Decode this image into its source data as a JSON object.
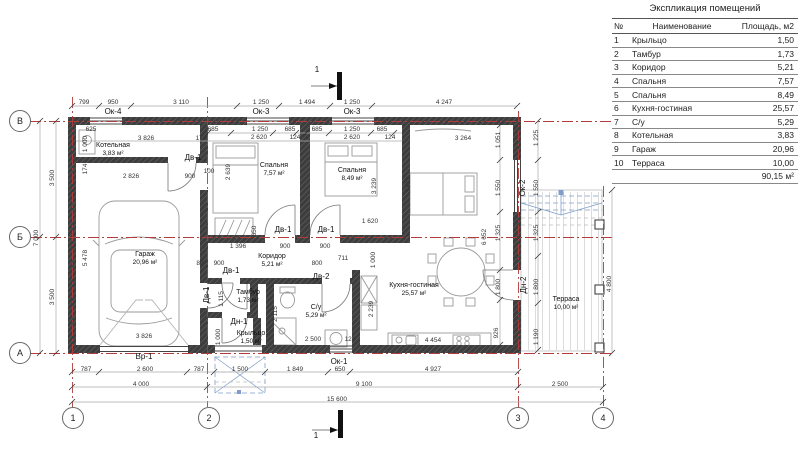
{
  "table": {
    "title": "Экспликация помещений",
    "headers": {
      "num": "№",
      "name": "Наименование",
      "area": "Площадь, м2"
    },
    "rows": [
      {
        "num": "1",
        "name": "Крыльцо",
        "area": "1,50"
      },
      {
        "num": "2",
        "name": "Тамбур",
        "area": "1,73"
      },
      {
        "num": "3",
        "name": "Коридор",
        "area": "5,21"
      },
      {
        "num": "4",
        "name": "Спальня",
        "area": "7,57"
      },
      {
        "num": "5",
        "name": "Спальня",
        "area": "8,49"
      },
      {
        "num": "6",
        "name": "Кухня-гостиная",
        "area": "25,57"
      },
      {
        "num": "7",
        "name": "С/у",
        "area": "5,29"
      },
      {
        "num": "8",
        "name": "Котельная",
        "area": "3,83"
      },
      {
        "num": "9",
        "name": "Гараж",
        "area": "20,96"
      },
      {
        "num": "10",
        "name": "Терраса",
        "area": "10,00"
      }
    ],
    "total": "90,15 м²"
  },
  "plan": {
    "rooms": [
      {
        "name": "Котельная",
        "area": "3,83 м²",
        "x": 113,
        "y": 150
      },
      {
        "name": "Гараж",
        "area": "20,96 м²",
        "x": 145,
        "y": 259
      },
      {
        "name": "Спальня",
        "area": "7,57 м²",
        "x": 274,
        "y": 170
      },
      {
        "name": "Спальня",
        "area": "8,49 м²",
        "x": 352,
        "y": 175
      },
      {
        "name": "Коридор",
        "area": "5,21 м²",
        "x": 272,
        "y": 261
      },
      {
        "name": "Тамбур",
        "area": "1,73 м²",
        "x": 248,
        "y": 297
      },
      {
        "name": "Крыльцо",
        "area": "1,50 м²",
        "x": 251,
        "y": 338
      },
      {
        "name": "С/у",
        "area": "5,29 м²",
        "x": 316,
        "y": 312
      },
      {
        "name": "Кухня-гостиная",
        "area": "25,57 м²",
        "x": 414,
        "y": 290
      },
      {
        "name": "Терраса",
        "area": "10,00 м²",
        "x": 566,
        "y": 304
      }
    ],
    "tags": [
      {
        "t": "Ок-4",
        "x": 113,
        "y": 112
      },
      {
        "t": "Ок-3",
        "x": 261,
        "y": 112
      },
      {
        "t": "Ок-3",
        "x": 352,
        "y": 112
      },
      {
        "t": "Ок-2",
        "x": 523,
        "y": 188,
        "v": 1
      },
      {
        "t": "Ок-1",
        "x": 339,
        "y": 362
      },
      {
        "t": "Вр-1",
        "x": 144,
        "y": 357
      },
      {
        "t": "Дв-1",
        "x": 193,
        "y": 158
      },
      {
        "t": "Дв-1",
        "x": 283,
        "y": 230
      },
      {
        "t": "Дв-1",
        "x": 326,
        "y": 230
      },
      {
        "t": "Дв-1",
        "x": 231,
        "y": 271
      },
      {
        "t": "Дв-1",
        "x": 207,
        "y": 295,
        "v": 1
      },
      {
        "t": "Дв-2",
        "x": 321,
        "y": 277
      },
      {
        "t": "Дн-1",
        "x": 239,
        "y": 322
      },
      {
        "t": "Дн-2",
        "x": 524,
        "y": 285,
        "v": 1
      }
    ],
    "sections": [
      {
        "t": "1",
        "x": 317,
        "y": 70
      },
      {
        "t": "1",
        "x": 316,
        "y": 436
      }
    ],
    "dims": [
      {
        "t": "799",
        "x": 84,
        "y": 103
      },
      {
        "t": "950",
        "x": 113,
        "y": 103
      },
      {
        "t": "3 110",
        "x": 181,
        "y": 103
      },
      {
        "t": "1 250",
        "x": 261,
        "y": 103
      },
      {
        "t": "1 494",
        "x": 307,
        "y": 103
      },
      {
        "t": "1 250",
        "x": 352,
        "y": 103
      },
      {
        "t": "4 247",
        "x": 444,
        "y": 103
      },
      {
        "t": "625",
        "x": 91,
        "y": 130
      },
      {
        "t": "685",
        "x": 213,
        "y": 130
      },
      {
        "t": "1 250",
        "x": 260,
        "y": 130
      },
      {
        "t": "685",
        "x": 290,
        "y": 130
      },
      {
        "t": "685",
        "x": 317,
        "y": 130
      },
      {
        "t": "1 250",
        "x": 352,
        "y": 130
      },
      {
        "t": "685",
        "x": 382,
        "y": 130
      },
      {
        "t": "3 826",
        "x": 146,
        "y": 139
      },
      {
        "t": "174",
        "x": 201,
        "y": 139
      },
      {
        "t": "2 620",
        "x": 259,
        "y": 138
      },
      {
        "t": "124",
        "x": 295,
        "y": 138
      },
      {
        "t": "2 620",
        "x": 352,
        "y": 138
      },
      {
        "t": "124",
        "x": 390,
        "y": 138
      },
      {
        "t": "3 264",
        "x": 463,
        "y": 139
      },
      {
        "t": "1 000",
        "x": 86,
        "y": 144,
        "v": 1
      },
      {
        "t": "174",
        "x": 86,
        "y": 169,
        "v": 1
      },
      {
        "t": "2 826",
        "x": 131,
        "y": 177
      },
      {
        "t": "900",
        "x": 190,
        "y": 177
      },
      {
        "t": "100",
        "x": 209,
        "y": 172
      },
      {
        "t": "2 639",
        "x": 229,
        "y": 172,
        "v": 1
      },
      {
        "t": "3 239",
        "x": 375,
        "y": 186,
        "v": 1
      },
      {
        "t": "3 413",
        "x": 409,
        "y": 185,
        "v": 1
      },
      {
        "t": "1 051",
        "x": 499,
        "y": 140,
        "v": 1
      },
      {
        "t": "1 225",
        "x": 537,
        "y": 138,
        "v": 1
      },
      {
        "t": "1 550",
        "x": 499,
        "y": 188,
        "v": 1
      },
      {
        "t": "1 550",
        "x": 537,
        "y": 188,
        "v": 1
      },
      {
        "t": "1 620",
        "x": 370,
        "y": 222
      },
      {
        "t": "650",
        "x": 255,
        "y": 231,
        "v": 1
      },
      {
        "t": "6 652",
        "x": 485,
        "y": 237,
        "v": 1
      },
      {
        "t": "1 325",
        "x": 499,
        "y": 233,
        "v": 1
      },
      {
        "t": "1 325",
        "x": 537,
        "y": 233,
        "v": 1
      },
      {
        "t": "1 396",
        "x": 238,
        "y": 247
      },
      {
        "t": "900",
        "x": 285,
        "y": 247
      },
      {
        "t": "900",
        "x": 325,
        "y": 247
      },
      {
        "t": "80",
        "x": 200,
        "y": 264
      },
      {
        "t": "900",
        "x": 219,
        "y": 264
      },
      {
        "t": "800",
        "x": 317,
        "y": 264
      },
      {
        "t": "711",
        "x": 343,
        "y": 259
      },
      {
        "t": "1 000",
        "x": 374,
        "y": 260,
        "v": 1
      },
      {
        "t": "1 115",
        "x": 222,
        "y": 299,
        "v": 1
      },
      {
        "t": "2 115",
        "x": 276,
        "y": 314,
        "v": 1
      },
      {
        "t": "2 239",
        "x": 372,
        "y": 309,
        "v": 1
      },
      {
        "t": "1 800",
        "x": 499,
        "y": 287,
        "v": 1
      },
      {
        "t": "1 800",
        "x": 537,
        "y": 287,
        "v": 1
      },
      {
        "t": "1 000",
        "x": 219,
        "y": 337,
        "v": 1
      },
      {
        "t": "926",
        "x": 497,
        "y": 333,
        "v": 1
      },
      {
        "t": "1 190",
        "x": 537,
        "y": 337,
        "v": 1
      },
      {
        "t": "4 800",
        "x": 610,
        "y": 284,
        "v": 1
      },
      {
        "t": "2 500",
        "x": 313,
        "y": 340
      },
      {
        "t": "124",
        "x": 350,
        "y": 340
      },
      {
        "t": "4 454",
        "x": 433,
        "y": 341
      },
      {
        "t": "3 826",
        "x": 144,
        "y": 337
      },
      {
        "t": "5 478",
        "x": 86,
        "y": 258,
        "v": 1
      },
      {
        "t": "3 500",
        "x": 53,
        "y": 178,
        "v": 1
      },
      {
        "t": "3 500",
        "x": 53,
        "y": 297,
        "v": 1
      },
      {
        "t": "7 000",
        "x": 37,
        "y": 238,
        "v": 1
      },
      {
        "t": "787",
        "x": 86,
        "y": 370
      },
      {
        "t": "2 600",
        "x": 145,
        "y": 370
      },
      {
        "t": "787",
        "x": 199,
        "y": 370
      },
      {
        "t": "1 500",
        "x": 240,
        "y": 370
      },
      {
        "t": "1 849",
        "x": 295,
        "y": 370
      },
      {
        "t": "650",
        "x": 340,
        "y": 370
      },
      {
        "t": "4 927",
        "x": 433,
        "y": 370
      },
      {
        "t": "4 000",
        "x": 141,
        "y": 385
      },
      {
        "t": "9 100",
        "x": 364,
        "y": 385
      },
      {
        "t": "2 500",
        "x": 560,
        "y": 385
      },
      {
        "t": "15 600",
        "x": 337,
        "y": 400
      }
    ],
    "axes": {
      "cols": [
        {
          "t": "1",
          "x": 73
        },
        {
          "t": "2",
          "x": 209
        },
        {
          "t": "3",
          "x": 518
        },
        {
          "t": "4",
          "x": 603
        }
      ],
      "col_y": 418,
      "rows": [
        {
          "t": "В",
          "y": 121
        },
        {
          "t": "Б",
          "y": 237
        },
        {
          "t": "А",
          "y": 353
        }
      ],
      "row_x": 20
    }
  },
  "colors": {
    "axis_red": "#b23b3b",
    "canopy_blue": "#7f9dc9",
    "wall_dark": "#3d3d3d",
    "dim_gray": "#999999"
  }
}
